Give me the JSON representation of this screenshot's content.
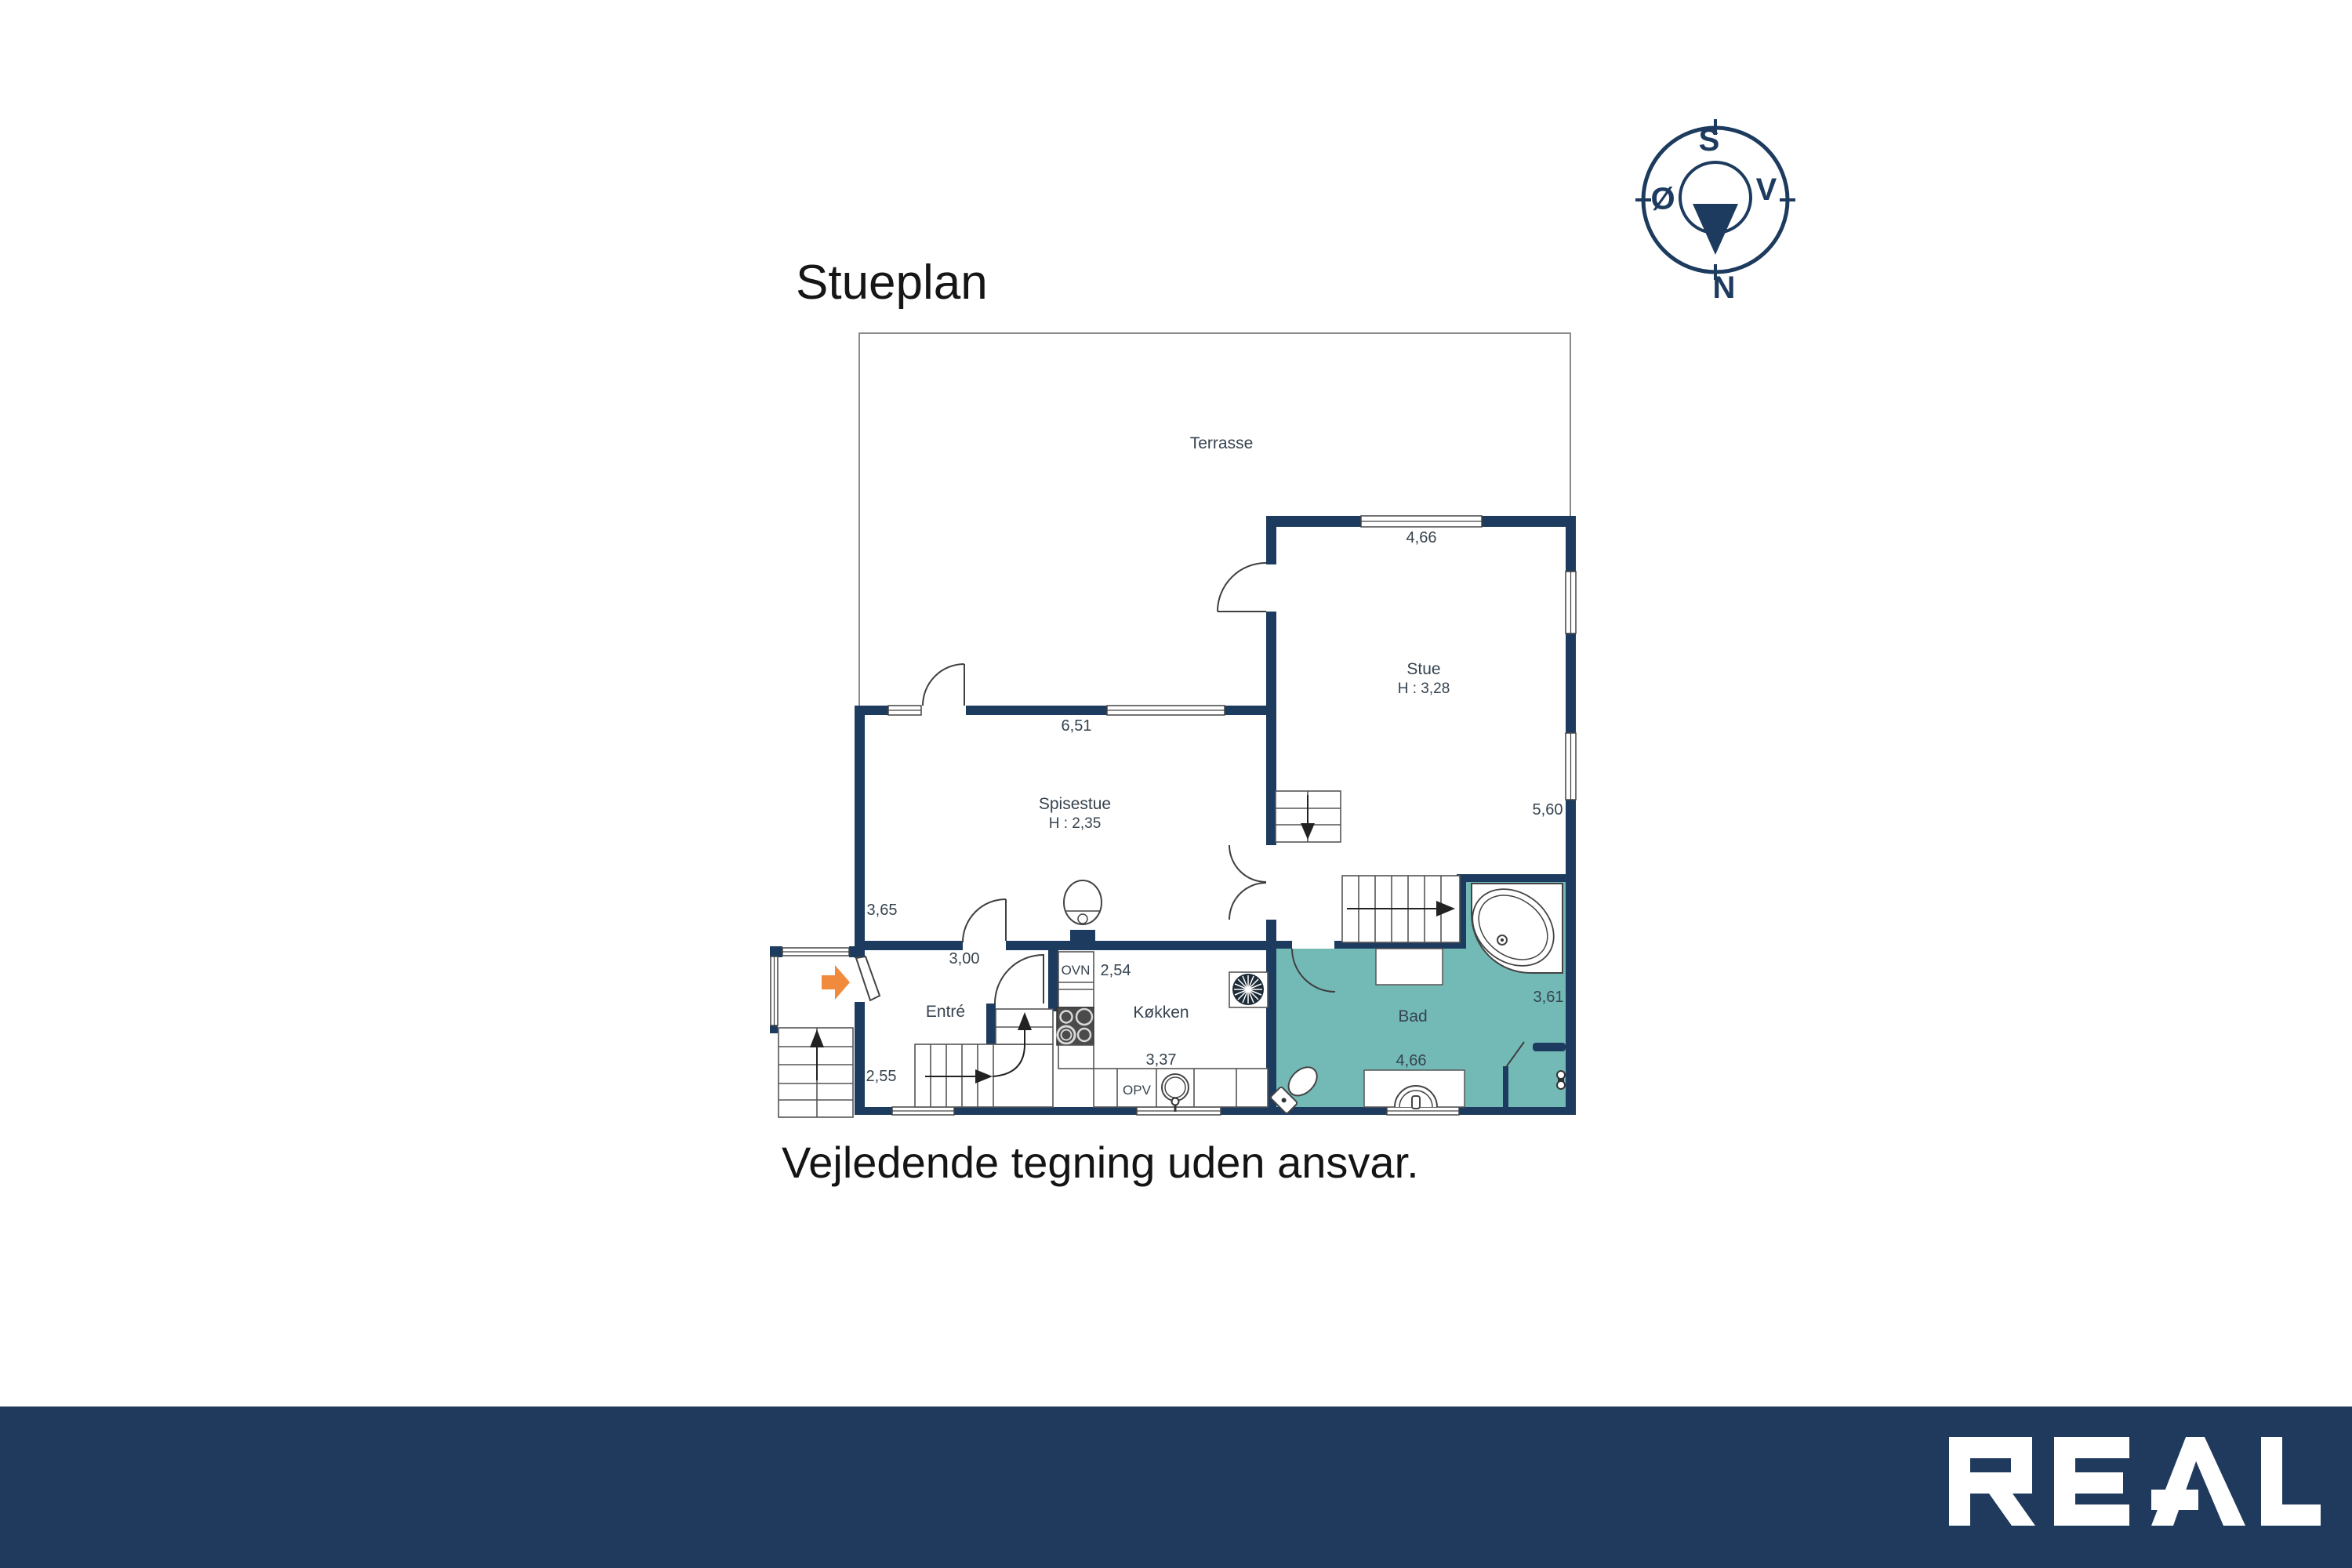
{
  "title": "Stueplan",
  "disclaimer": "Vejledende tegning uden ansvar.",
  "compass": {
    "n": "N",
    "s": "S",
    "v": "V",
    "o": "Ø"
  },
  "logo_text": "REAL",
  "colors": {
    "wall": "#1d3b5e",
    "bath": "#73bab6",
    "accent-orange": "#f08a3c",
    "footer": "#1f3a5d",
    "label": "#36434f",
    "line": "#3f3f3f",
    "thin": "#555555",
    "outline": "#8a8a8a"
  },
  "rooms": {
    "terrasse": {
      "label": "Terrasse"
    },
    "stue": {
      "label": "Stue",
      "ceiling_height": "H : 3,28",
      "width": "4,66",
      "depth": "5,60"
    },
    "spisestue": {
      "label": "Spisestue",
      "ceiling_height": "H : 2,35",
      "width": "6,51",
      "depth": "3,65"
    },
    "entre": {
      "label": "Entré",
      "width": "3,00",
      "depth": "2,55"
    },
    "kokken": {
      "label": "Køkken",
      "width": "3,37",
      "dim": "2,54",
      "oven": "OVN",
      "dishwasher": "OPV"
    },
    "bad": {
      "label": "Bad",
      "width": "4,66",
      "depth": "3,61"
    }
  }
}
